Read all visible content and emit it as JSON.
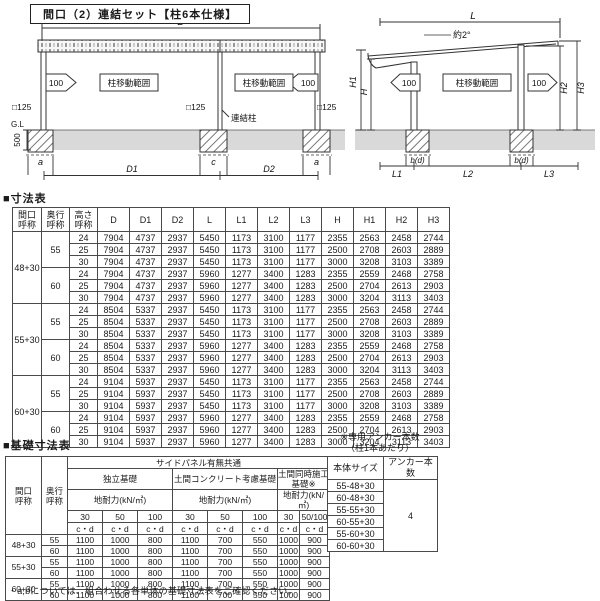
{
  "title": "間口（2）連結セット【柱6本仕様】",
  "colors": {
    "ground_band": "#d9d9d9",
    "line": "#333333"
  },
  "diagrams": {
    "front": {
      "dim_total": "D",
      "dim_left": "D1",
      "dim_right": "D2",
      "move_range": "柱移動範囲",
      "arrow_value": "100",
      "post_size": "□125",
      "joint_post": "連結柱",
      "ground_line": "G.L",
      "embed_depth": "500",
      "footing_a": "a",
      "footing_c": "c"
    },
    "side": {
      "dim_total": "L",
      "slope": "約2°",
      "move_range": "柱移動範囲",
      "arrow_value": "100",
      "h": "H",
      "h1": "H1",
      "h2": "H2",
      "h3": "H3",
      "footing_bd": "b(d)",
      "l1": "L1",
      "l2": "L2",
      "l3": "L3"
    }
  },
  "dim_table": {
    "heading": "■寸法表",
    "headers": [
      "間口\n呼称",
      "奥行\n呼称",
      "高さ\n呼称",
      "D",
      "D1",
      "D2",
      "L",
      "L1",
      "L2",
      "L3",
      "H",
      "H1",
      "H2",
      "H3"
    ],
    "groups": [
      {
        "width": "48+30",
        "depths": [
          {
            "depth": "55",
            "rows": [
              [
                "24",
                "7904",
                "4737",
                "2937",
                "5450",
                "1173",
                "3100",
                "1177",
                "2355",
                "2563",
                "2458",
                "2744"
              ],
              [
                "25",
                "7904",
                "4737",
                "2937",
                "5450",
                "1173",
                "3100",
                "1177",
                "2500",
                "2708",
                "2603",
                "2889"
              ],
              [
                "30",
                "7904",
                "4737",
                "2937",
                "5450",
                "1173",
                "3100",
                "1177",
                "3000",
                "3208",
                "3103",
                "3389"
              ]
            ]
          },
          {
            "depth": "60",
            "rows": [
              [
                "24",
                "7904",
                "4737",
                "2937",
                "5960",
                "1277",
                "3400",
                "1283",
                "2355",
                "2559",
                "2468",
                "2758"
              ],
              [
                "25",
                "7904",
                "4737",
                "2937",
                "5960",
                "1277",
                "3400",
                "1283",
                "2500",
                "2704",
                "2613",
                "2903"
              ],
              [
                "30",
                "7904",
                "4737",
                "2937",
                "5960",
                "1277",
                "3400",
                "1283",
                "3000",
                "3204",
                "3113",
                "3403"
              ]
            ]
          }
        ]
      },
      {
        "width": "55+30",
        "depths": [
          {
            "depth": "55",
            "rows": [
              [
                "24",
                "8504",
                "5337",
                "2937",
                "5450",
                "1173",
                "3100",
                "1177",
                "2355",
                "2563",
                "2458",
                "2744"
              ],
              [
                "25",
                "8504",
                "5337",
                "2937",
                "5450",
                "1173",
                "3100",
                "1177",
                "2500",
                "2708",
                "2603",
                "2889"
              ],
              [
                "30",
                "8504",
                "5337",
                "2937",
                "5450",
                "1173",
                "3100",
                "1177",
                "3000",
                "3208",
                "3103",
                "3389"
              ]
            ]
          },
          {
            "depth": "60",
            "rows": [
              [
                "24",
                "8504",
                "5337",
                "2937",
                "5960",
                "1277",
                "3400",
                "1283",
                "2355",
                "2559",
                "2468",
                "2758"
              ],
              [
                "25",
                "8504",
                "5337",
                "2937",
                "5960",
                "1277",
                "3400",
                "1283",
                "2500",
                "2704",
                "2613",
                "2903"
              ],
              [
                "30",
                "8504",
                "5337",
                "2937",
                "5960",
                "1277",
                "3400",
                "1283",
                "3000",
                "3204",
                "3113",
                "3403"
              ]
            ]
          }
        ]
      },
      {
        "width": "60+30",
        "depths": [
          {
            "depth": "55",
            "rows": [
              [
                "24",
                "9104",
                "5937",
                "2937",
                "5450",
                "1173",
                "3100",
                "1177",
                "2355",
                "2563",
                "2458",
                "2744"
              ],
              [
                "25",
                "9104",
                "5937",
                "2937",
                "5450",
                "1173",
                "3100",
                "1177",
                "2500",
                "2708",
                "2603",
                "2889"
              ],
              [
                "30",
                "9104",
                "5937",
                "2937",
                "5450",
                "1173",
                "3100",
                "1177",
                "3000",
                "3208",
                "3103",
                "3389"
              ]
            ]
          },
          {
            "depth": "60",
            "rows": [
              [
                "24",
                "9104",
                "5937",
                "2937",
                "5960",
                "1277",
                "3400",
                "1283",
                "2355",
                "2559",
                "2468",
                "2758"
              ],
              [
                "25",
                "9104",
                "5937",
                "2937",
                "5960",
                "1277",
                "3400",
                "1283",
                "2500",
                "2704",
                "2613",
                "2903"
              ],
              [
                "30",
                "9104",
                "5937",
                "2937",
                "5960",
                "1277",
                "3400",
                "1283",
                "3000",
                "3204",
                "3113",
                "3403"
              ]
            ]
          }
        ]
      }
    ]
  },
  "foundation_table": {
    "heading": "■基礎寸法表",
    "col_width": "間口\n呼称",
    "col_depth": "奥行\n呼称",
    "side_panel_header": "サイドパネル有無共通",
    "col_groups": [
      {
        "name": "独立基礎",
        "sub": "地耐力(kN/㎡)",
        "cols": [
          "30",
          "50",
          "100"
        ]
      },
      {
        "name": "土間コンクリート考慮基礎",
        "sub": "地耐力(kN/㎡)",
        "cols": [
          "30",
          "50",
          "100"
        ]
      },
      {
        "name": "土間同時施工基礎※",
        "sub": "地耐力(kN/㎡)",
        "cols": [
          "30",
          "50/100"
        ]
      }
    ],
    "cd_label": "c・d",
    "groups": [
      {
        "width": "48+30",
        "rows": [
          {
            "depth": "55",
            "values": [
              "1100",
              "1000",
              "800",
              "1100",
              "700",
              "550",
              "1000",
              "900"
            ]
          },
          {
            "depth": "60",
            "values": [
              "1100",
              "1000",
              "800",
              "1100",
              "700",
              "550",
              "1000",
              "900"
            ]
          }
        ]
      },
      {
        "width": "55+30",
        "rows": [
          {
            "depth": "55",
            "values": [
              "1100",
              "1000",
              "800",
              "1100",
              "700",
              "550",
              "1000",
              "900"
            ]
          },
          {
            "depth": "60",
            "values": [
              "1100",
              "1000",
              "800",
              "1100",
              "700",
              "550",
              "1000",
              "900"
            ]
          }
        ]
      },
      {
        "width": "60+30",
        "rows": [
          {
            "depth": "55",
            "values": [
              "1100",
              "1000",
              "800",
              "1100",
              "700",
              "550",
              "1000",
              "900"
            ]
          },
          {
            "depth": "60",
            "values": [
              "1100",
              "1000",
              "800",
              "1100",
              "700",
              "550",
              "1000",
              "900"
            ]
          }
        ]
      }
    ],
    "footnote": "・a,bについては、組合わせる各単体の基礎寸法表をご確認ください。"
  },
  "anchor_note": {
    "line1": "※専用アンカー本数",
    "line2": "（柱1本あたり）"
  },
  "anchor_table": {
    "header_size": "本体サイズ",
    "header_count": "アンカー本数",
    "sizes": [
      "55-48+30",
      "60-48+30",
      "55-55+30",
      "60-55+30",
      "55-60+30",
      "60-60+30"
    ],
    "count": "4"
  }
}
